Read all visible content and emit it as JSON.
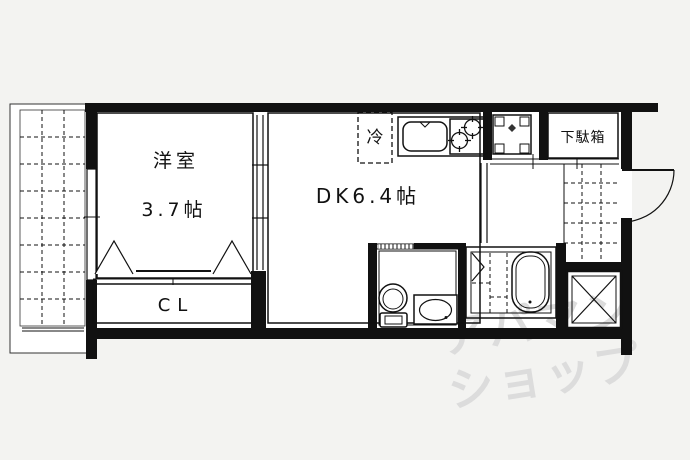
{
  "image_type": "apartment-floor-plan",
  "floorplan": {
    "rooms": {
      "western_room": {
        "name": "洋室",
        "size": "3.7帖"
      },
      "dining_kitchen": {
        "name": "DK6.4帖"
      },
      "closet": {
        "label": "CL"
      },
      "shoe_cabinet": {
        "label": "下駄箱"
      },
      "refrigerator": {
        "label": "冷"
      }
    },
    "watermark": {
      "line1": "アパマン",
      "line2": "ショップ"
    },
    "colors": {
      "line": "#111111",
      "background": "#f3f3f1",
      "floor_fill": "#ffffff",
      "watermark": "#dcdcdc"
    }
  }
}
